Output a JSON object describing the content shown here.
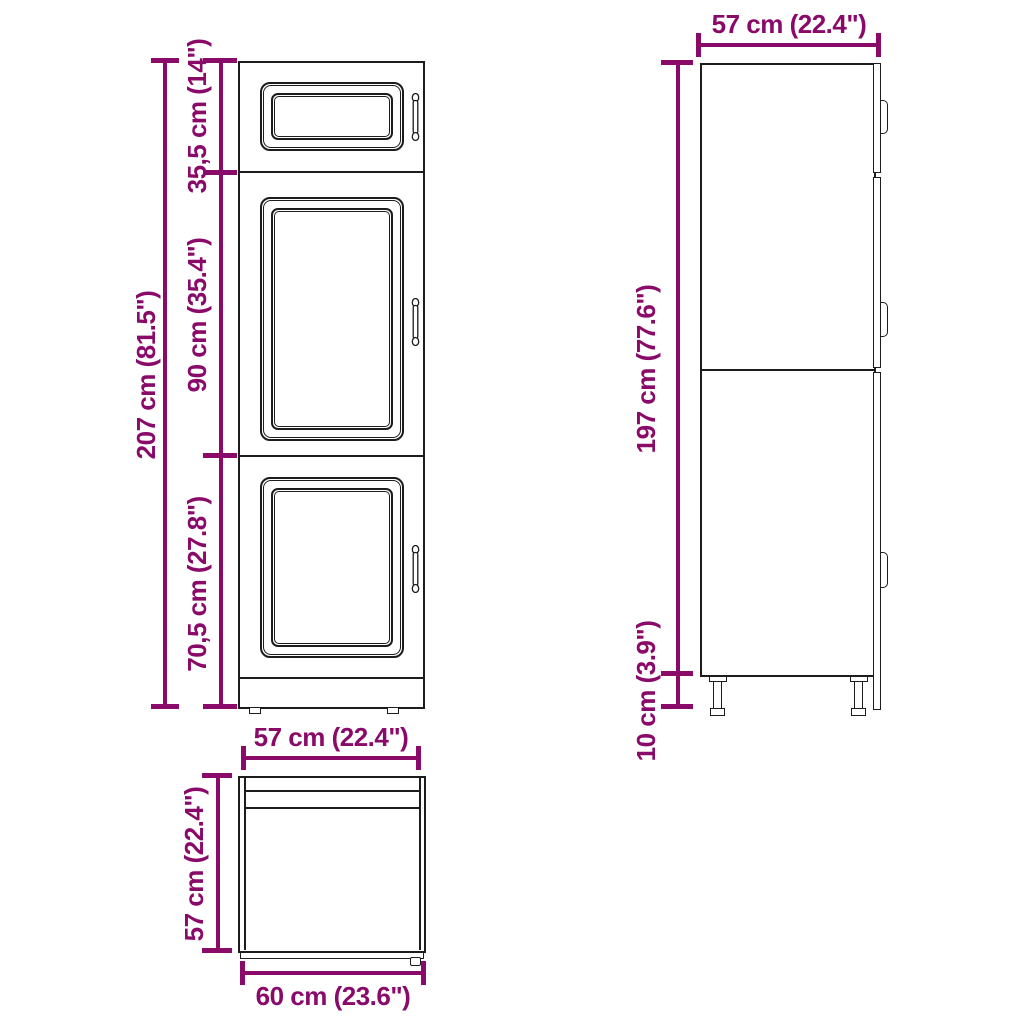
{
  "title": "Kitchen cabinet dimension diagram",
  "views": {
    "front": {
      "dims": {
        "total_height": "207 cm (81.5\")",
        "top_section_height": "35,5 cm (14\")",
        "middle_section_height": "90 cm (35.4\")",
        "bottom_section_height": "70,5 cm (27.8\")"
      }
    },
    "side": {
      "dims": {
        "width": "57 cm (22.4\")",
        "body_height": "197 cm (77.6\")",
        "leg_height": "10 cm (3.9\")"
      }
    },
    "top": {
      "dims": {
        "top_width": "57 cm (22.4\")",
        "depth": "57 cm (22.4\")",
        "bottom_width": "60 cm (23.6\")"
      }
    }
  },
  "colors": {
    "dimension": "#8a0a6a",
    "outline": "#1c1c1c",
    "background": "#ffffff"
  }
}
